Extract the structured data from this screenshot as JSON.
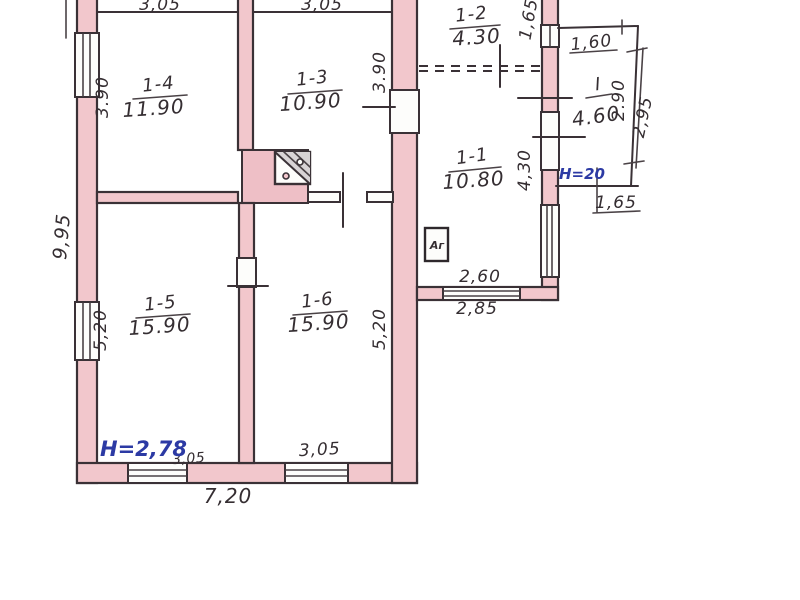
{
  "plan": {
    "type": "apartment-floor-plan-scan",
    "colors": {
      "wall_fill": "#f2c7cc",
      "ink": "#3a3136",
      "blue_ink": "#2c3aa4",
      "paper": "#ffffff"
    },
    "rooms": [
      {
        "number": "1-4",
        "area": "11.90"
      },
      {
        "number": "1-3",
        "area": "10.90"
      },
      {
        "number": "1-2",
        "area": "4.30"
      },
      {
        "number": "1-1",
        "area": "10.80"
      },
      {
        "number": "1-5",
        "area": "15.90"
      },
      {
        "number": "1-6",
        "area": "15.90"
      },
      {
        "number": "I",
        "area": "4.60"
      }
    ],
    "dims": {
      "top_1_4": "3,05",
      "top_1_3": "3,05",
      "left_1_4": "3.90",
      "left_total": "9,95",
      "left_1_5": "5,20",
      "right_1_3": "3.90",
      "right_1_6": "5,20",
      "wing_1_2": "1,65",
      "wing_1_1": "4,30",
      "porch_top": "1,60",
      "porch_side_inner": "2.90",
      "porch_side_outer": "2,95",
      "porch_bottom": "1,65",
      "wing_bottom_inner": "2,60",
      "wing_bottom_outer": "2,85",
      "bottom_1_5": "3,05",
      "bottom_1_6": "3,05",
      "bottom_total": "7,20"
    },
    "notes": {
      "height_main": "Н=2,78",
      "height_porch": "Н=20",
      "appliance": "Аг"
    }
  }
}
